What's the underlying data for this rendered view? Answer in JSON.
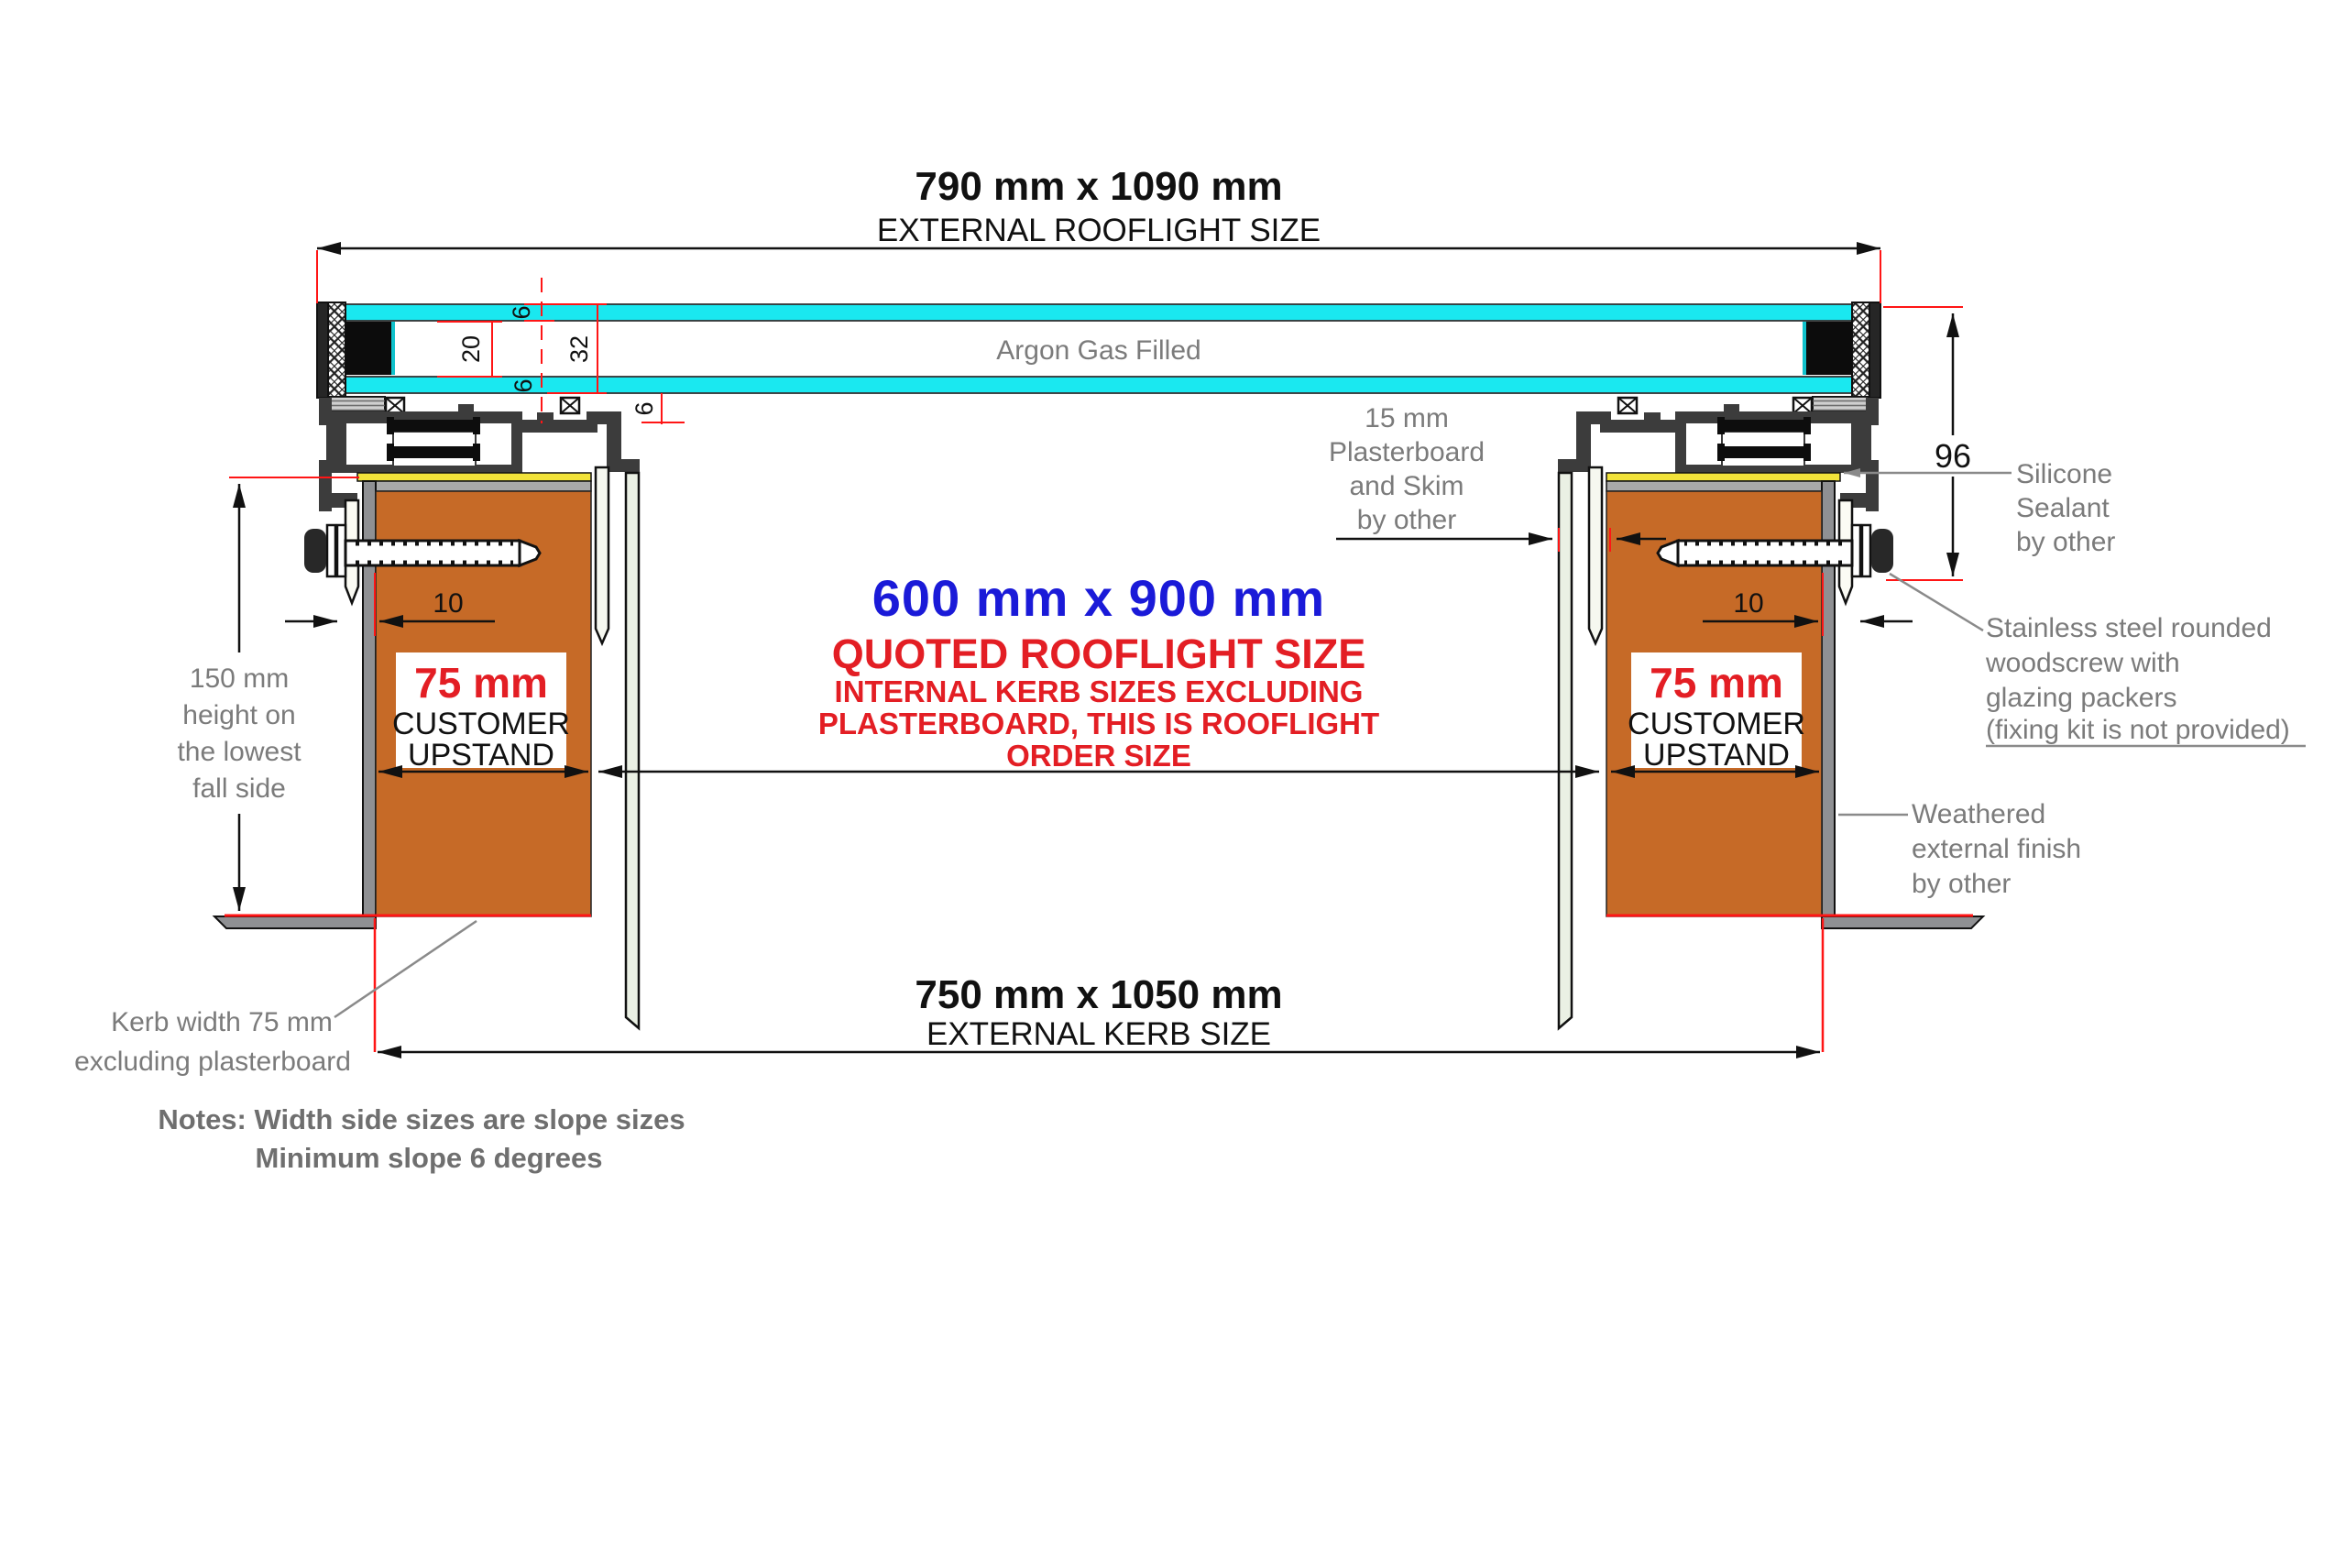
{
  "top_dimension": {
    "size": "790 mm x 1090 mm",
    "label": "EXTERNAL ROOFLIGHT SIZE"
  },
  "glazing": {
    "fill_label": "Argon Gas Filled",
    "dim_pane_top": "6",
    "dim_cavity": "20",
    "dim_unit": "32",
    "dim_pane_bottom": "6",
    "dim_step": "6"
  },
  "frame": {
    "height_dim": "96"
  },
  "quoted_size": {
    "size": "600 mm x 900 mm",
    "title": "QUOTED ROOFLIGHT SIZE",
    "sub1": "INTERNAL KERB SIZES EXCLUDING",
    "sub2": "PLASTERBOARD, THIS IS ROOFLIGHT",
    "sub3": "ORDER SIZE"
  },
  "left_kerb": {
    "size": "75 mm",
    "label1": "CUSTOMER",
    "label2": "UPSTAND",
    "gap_dim": "10"
  },
  "right_kerb": {
    "size": "75 mm",
    "label1": "CUSTOMER",
    "label2": "UPSTAND",
    "gap_dim": "10"
  },
  "height_note": {
    "l1": "150 mm",
    "l2": "height on",
    "l3": "the lowest",
    "l4": "fall side"
  },
  "plasterboard_note": {
    "l1": "15 mm",
    "l2": "Plasterboard",
    "l3": "and Skim",
    "l4": "by other"
  },
  "silicone_note": {
    "l1": "Silicone",
    "l2": "Sealant",
    "l3": "by other"
  },
  "screw_note": {
    "l1": "Stainless steel rounded",
    "l2": "woodscrew with",
    "l3": "glazing packers",
    "l4": "(fixing kit is not provided)"
  },
  "weathered_note": {
    "l1": "Weathered",
    "l2": "external finish",
    "l3": "by other"
  },
  "kerb_width_note": {
    "l1": "Kerb width 75 mm",
    "l2": "excluding plasterboard"
  },
  "bottom_dimension": {
    "size": "750 mm x 1050 mm",
    "label": "EXTERNAL KERB SIZE"
  },
  "notes": {
    "l1": "Notes: Width side sizes are slope sizes",
    "l2": "Minimum slope 6 degrees"
  },
  "colors": {
    "accent_red": "#e31e24",
    "accent_blue": "#1a1ad8",
    "dimension_red": "#ff1515",
    "kerb_orange": "#c66a27",
    "glass_cyan": "#1ae8f0",
    "gasket_yellow": "#f2e33a",
    "annotation_gray": "#7b7b7b",
    "frame_dark": "#3c3c3c"
  }
}
